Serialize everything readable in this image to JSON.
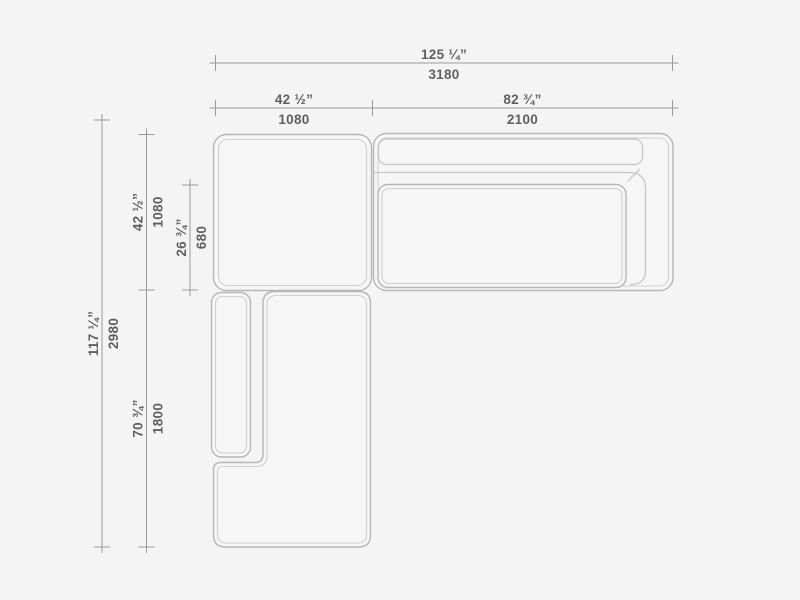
{
  "drawing": {
    "type": "sectional-sofa-top-view-technical-drawing",
    "background_color": "#f4f4f4",
    "outline_color": "#b6b6b6",
    "inner_outline_color": "#d0d0d0",
    "dimension_line_color": "#9a9a9a",
    "text_color": "#5f5f5f",
    "dimensions": {
      "overall_width": {
        "inches": "125 ¼”",
        "mm": "3180"
      },
      "left_section_width": {
        "inches": "42 ½”",
        "mm": "1080"
      },
      "right_section_width": {
        "inches": "82 ¾”",
        "mm": "2100"
      },
      "overall_depth": {
        "inches": "117 ¼”",
        "mm": "2980"
      },
      "top_section_depth": {
        "inches": "42 ½”",
        "mm": "1080"
      },
      "seat_depth": {
        "inches": "26 ¾”",
        "mm": "680"
      },
      "chaise_length": {
        "inches": "70 ¾”",
        "mm": "1800"
      }
    }
  }
}
